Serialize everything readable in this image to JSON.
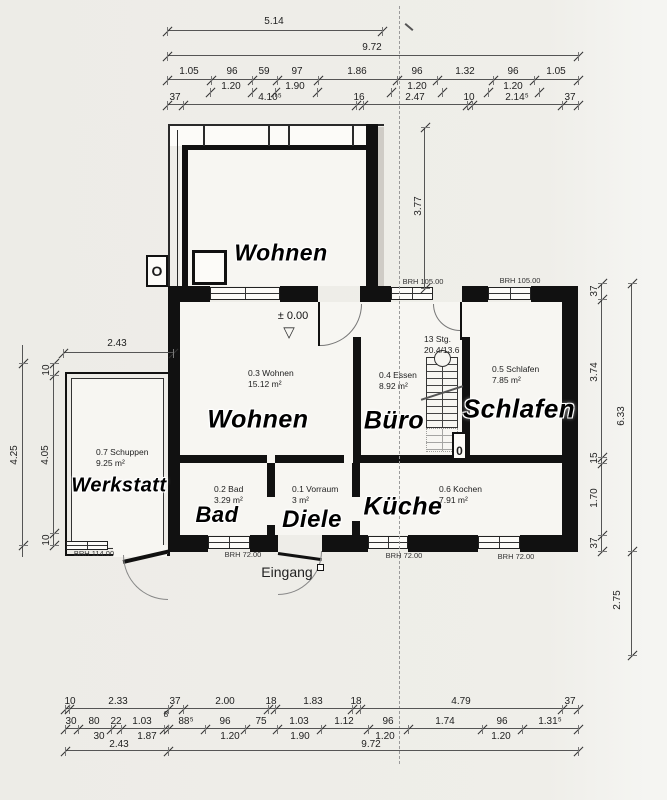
{
  "meta": {
    "paper_color": "#efeee9",
    "ink_color": "#111111",
    "dim_color": "#555555"
  },
  "rooms": {
    "wohnen_oben": {
      "label": "Wohnen"
    },
    "wohnen": {
      "label": "Wohnen",
      "id": "0.3 Wohnen",
      "area": "15.12 m²"
    },
    "buero": {
      "label": "Büro",
      "id": "0.4 Essen",
      "area": "8.92 m²"
    },
    "schlafen": {
      "label": "Schlafen",
      "id": "0.5 Schlafen",
      "area": "7.85 m²"
    },
    "werkstatt": {
      "label": "Werkstatt",
      "id": "0.7 Schuppen",
      "area": "9.25 m²"
    },
    "bad": {
      "label": "Bad",
      "id": "0.2 Bad",
      "area": "3.29 m²"
    },
    "diele": {
      "label": "Diele",
      "id": "0.1 Vorraum",
      "area": "3 m²"
    },
    "kueche": {
      "label": "Küche",
      "id": "0.6 Kochen",
      "area": "7.91 m²"
    },
    "eingang": {
      "label": "Eingang"
    }
  },
  "annotations": {
    "level": "± 0.00",
    "level_triangle": "▽",
    "stairs_count": "13 Stg.",
    "stairs_ratio": "20.4/13.6",
    "brh105_left": "BRH 105.00",
    "brh105_right": "BRH 105.00",
    "brh114": "BRH 114.00",
    "brh72_bad": "BRH 72.00",
    "brh72_kueche1": "BRH 72.00",
    "brh72_kueche2": "BRH 72.00",
    "symbol_o": "O",
    "symbol_zero": "0"
  },
  "dims": {
    "top": {
      "d514": "5.14",
      "d972": "9.72",
      "row3": [
        "1.05",
        "96",
        "59",
        "97",
        "1.86",
        "96",
        "1.32",
        "96",
        "1.05"
      ],
      "row3b": [
        "1.20",
        "1.90",
        "1.20",
        "1.20"
      ],
      "row4": [
        "37",
        "4.10⁵",
        "16",
        "2.47",
        "10",
        "2.14⁵",
        "37"
      ]
    },
    "bottom": {
      "row1": [
        "10",
        "2.33",
        "37",
        "2.00",
        "18",
        "1.83",
        "18",
        "4.79",
        "37"
      ],
      "row2": [
        "30",
        "80",
        "22",
        "1.03",
        "8",
        "88⁵",
        "96",
        "75",
        "1.03",
        "1.12",
        "96",
        "1.74",
        "96",
        "1.31⁵"
      ],
      "row3": [
        "30",
        "1.87",
        "1.20",
        "1.90",
        "1.20",
        "1.20"
      ],
      "d243": "2.43",
      "d972": "9.72"
    },
    "left": {
      "werkstatt_width": "2.43",
      "tick_top": "10",
      "inner": "4.05",
      "tick_bottom": "10",
      "outer": "4.25"
    },
    "right": {
      "r37a": "37",
      "r374": "3.74",
      "r15": "15",
      "r170": "1.70",
      "r37b": "37",
      "r633": "6.33",
      "r275": "2.75",
      "r377": "3.77"
    }
  }
}
